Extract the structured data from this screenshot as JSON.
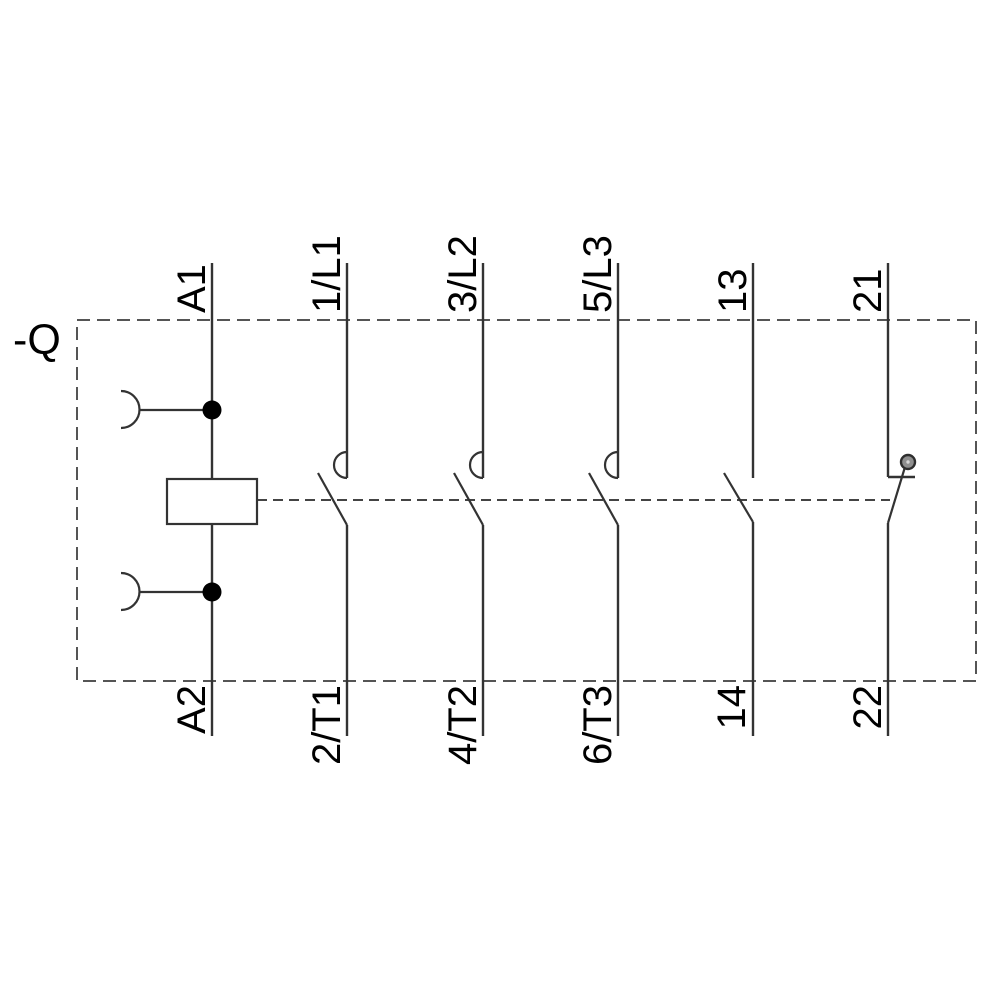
{
  "diagram": {
    "device_tag": "-Q",
    "terminals_top": [
      "A1",
      "1/L1",
      "3/L2",
      "5/L3",
      "13",
      "21"
    ],
    "terminals_bottom": [
      "A2",
      "2/T1",
      "4/T2",
      "6/T3",
      "14",
      "22"
    ],
    "symbols": {
      "coil": "contactor-coil-symbol",
      "coil_taps": "plug-socket-symbol",
      "main_poles": "no-main-contact-symbol",
      "aux_no": "no-auxiliary-contact-symbol",
      "aux_nc": "nc-auxiliary-contact-symbol",
      "linkage": "mechanical-linkage-dashed-line",
      "enclosure": "device-boundary-dashed-box"
    },
    "colors": {
      "background": "#ffffff",
      "line": "#333333",
      "boundary_dash": "#555555",
      "linkage_dash": "#444444",
      "text": "#000000",
      "junction_dot": "#000000",
      "nc_pivot_fill": "#8f8f8f",
      "nc_pivot_ring": "#2e2e2e"
    }
  }
}
